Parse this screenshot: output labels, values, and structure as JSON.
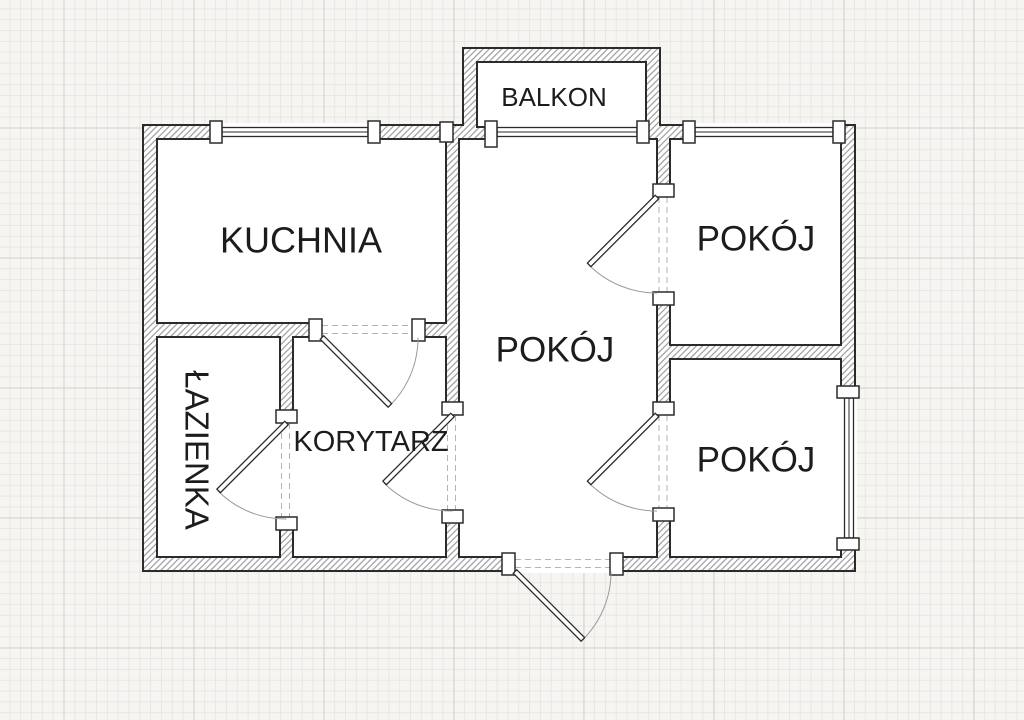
{
  "floor_plan": {
    "rooms": {
      "kuchnia": "KUCHNIA",
      "lazienka": "ŁAZIENKA",
      "korytarz": "KORYTARZ",
      "pokoj_center": "POKÓJ",
      "pokoj_top_right": "POKÓJ",
      "pokoj_bottom_right": "POKÓJ",
      "balkon": "BALKON"
    },
    "colors": {
      "paper_background": "#f6f5f2",
      "grid_minor_line": "#e9e7e4",
      "grid_major_line": "#d3d1cd",
      "wall_outline": "#2b2b2b",
      "wall_hatch_line": "#8a8a8a",
      "room_fill": "#ffffff",
      "label_text": "#1c1c1c",
      "door_swing_arc": "#9a9a9a",
      "opening_dash": "#b3b3b3"
    }
  }
}
